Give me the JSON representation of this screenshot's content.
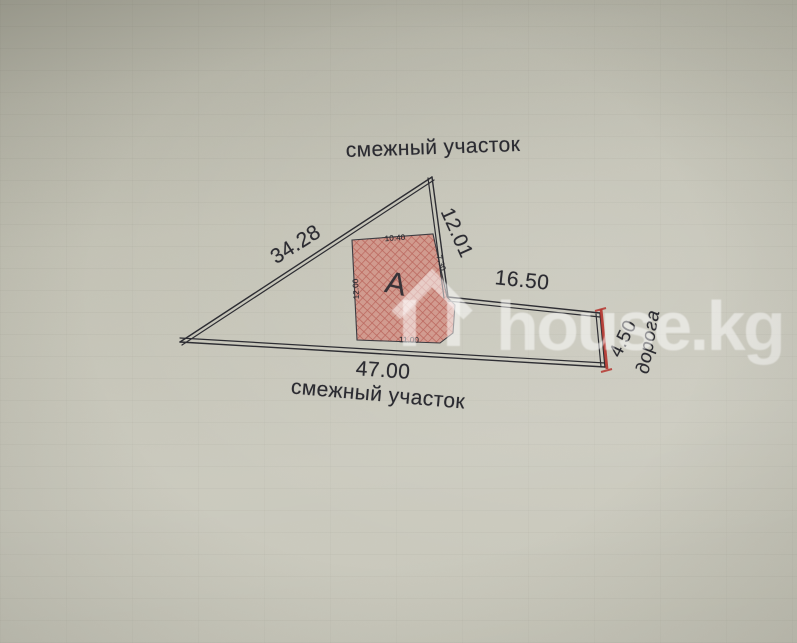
{
  "photo": {
    "watermark": {
      "text": "house.kg",
      "icon": "house-icon",
      "color": "#ffffff"
    },
    "plan": {
      "adjacent_top": "смежный участок",
      "adjacent_bottom": "смежный участок",
      "road_label": "дорога",
      "dimensions": {
        "left": "34.28",
        "right": "12.01",
        "upper_right": "16.50",
        "bottom": "47.00",
        "road": "4.50"
      },
      "building": {
        "letter": "А",
        "top": "10.40",
        "right": "7.30",
        "left": "12.00",
        "bottom": "11.00"
      },
      "colors": {
        "paper": "#c6c5b8",
        "ink": "#2b2b31",
        "road_red": "#b5342e",
        "hatch_red": "#a8312b",
        "hatch_fill": "#d8756a"
      }
    }
  }
}
